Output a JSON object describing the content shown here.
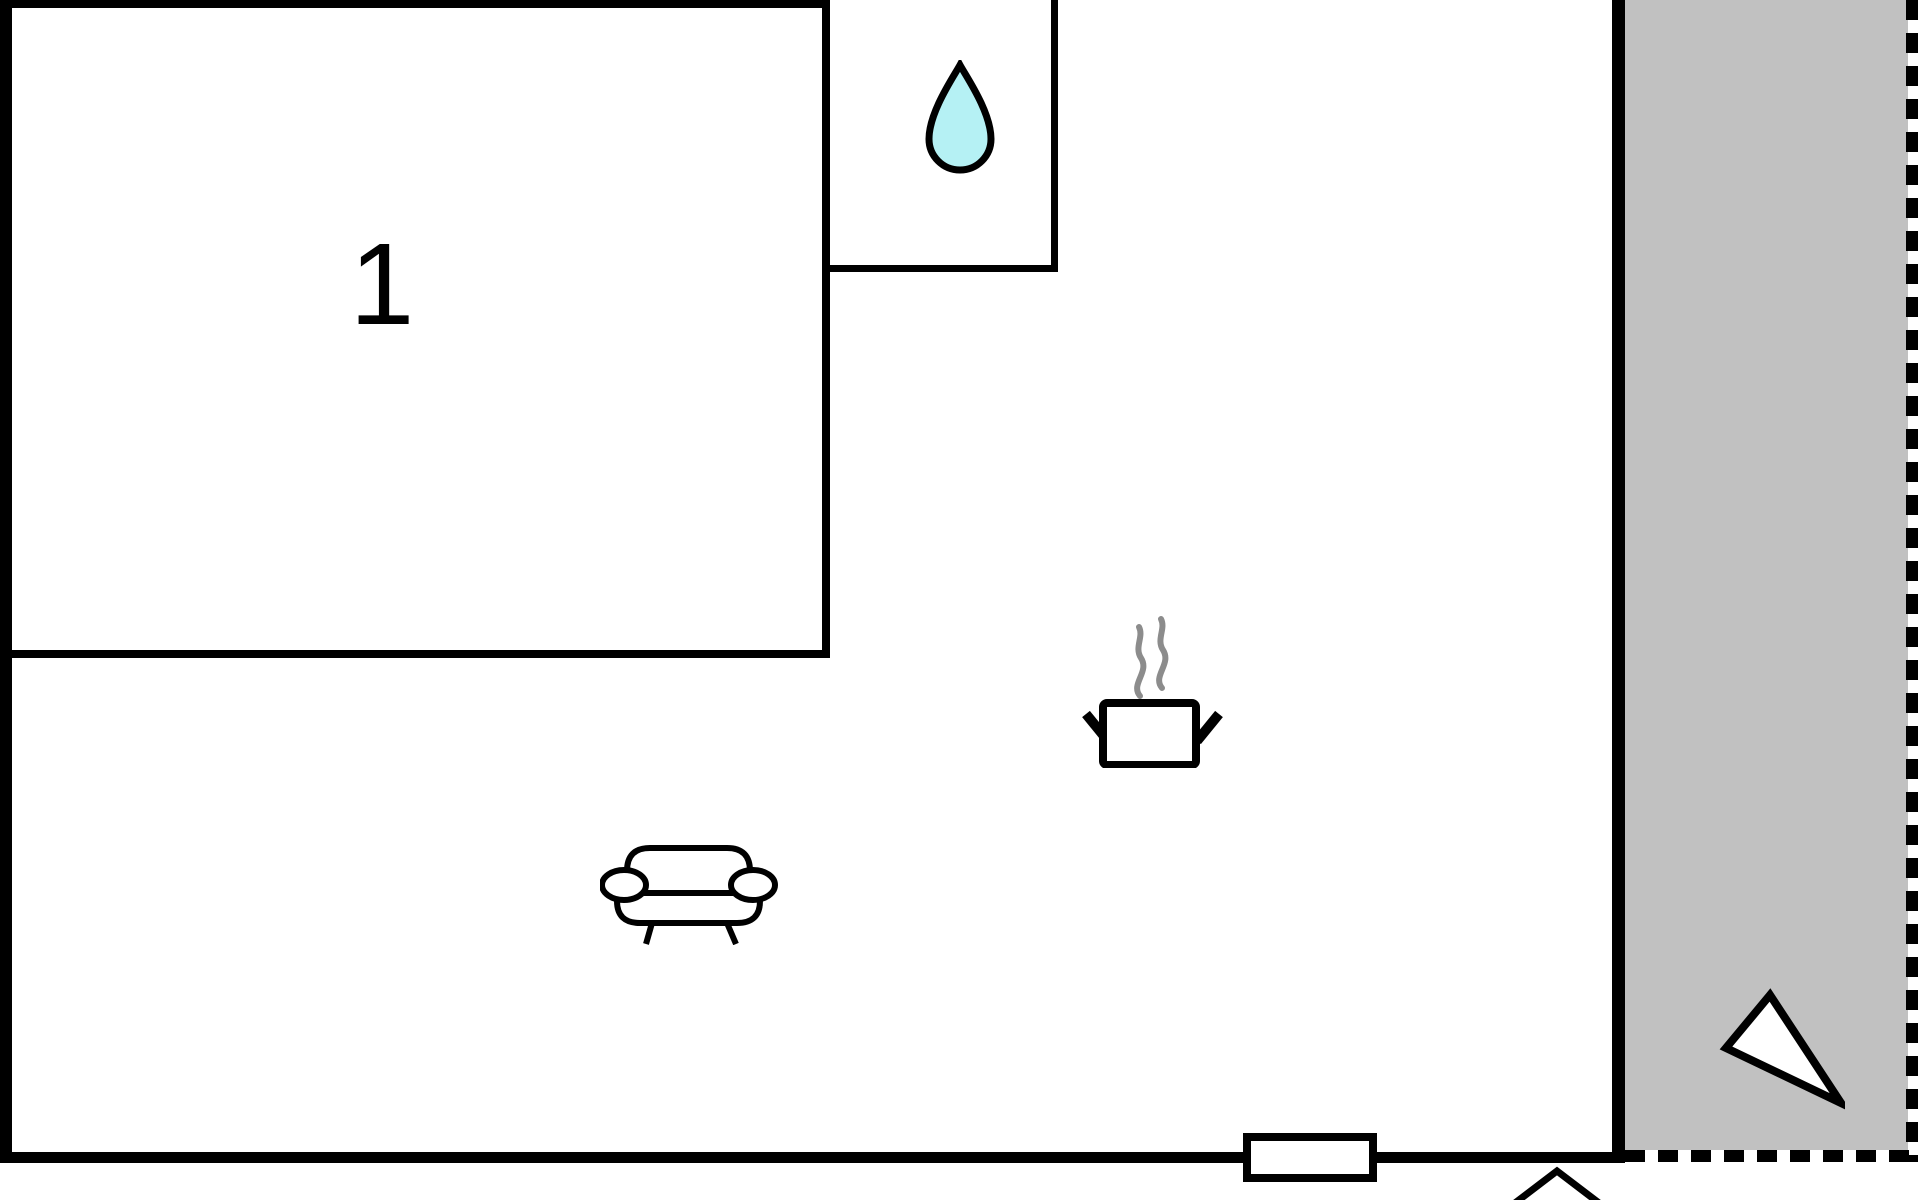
{
  "floor_plan": {
    "room_label": "1",
    "icons": {
      "water_drop": "water-drop-icon",
      "cooking_pot": "cooking-pot-icon",
      "sofa": "sofa-icon",
      "north_arrow": "north-arrow-icon",
      "door_swing": "door-swing-icon",
      "window": "window-marker"
    },
    "colors": {
      "wall": "#000000",
      "terrace_fill": "#c1c1c1",
      "water_drop_fill": "#b5f1f4",
      "steam": "#8c8c8c",
      "background": "#ffffff"
    }
  }
}
